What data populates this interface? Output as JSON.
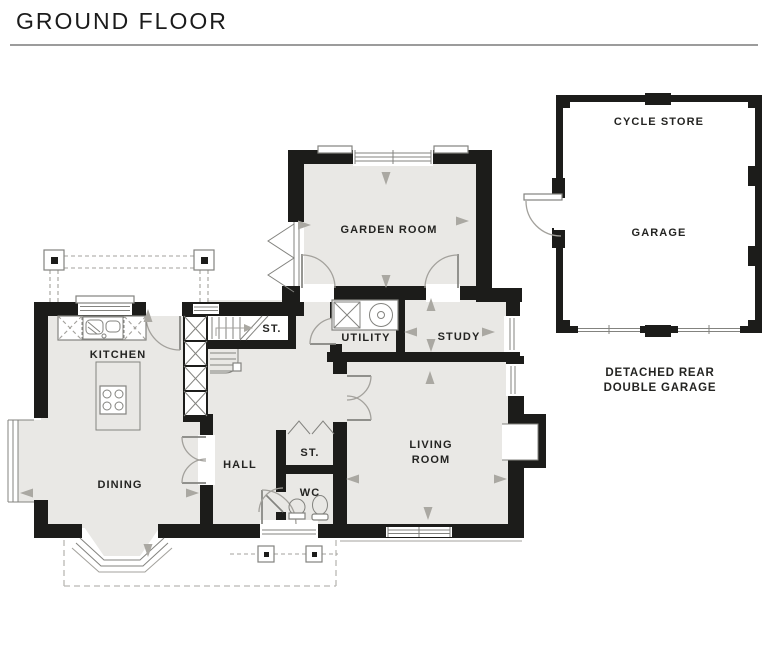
{
  "title": "GROUND FLOOR",
  "labels": {
    "garden_room": "GARDEN ROOM",
    "kitchen": "KITCHEN",
    "dining": "DINING",
    "hall": "HALL",
    "stair_store": "ST.",
    "utility": "UTILITY",
    "study": "STUDY",
    "hall_store": "ST.",
    "wc": "WC",
    "living_line1": "LIVING",
    "living_line2": "ROOM",
    "cycle_store": "CYCLE STORE",
    "garage": "GARAGE",
    "caption_line1": "DETACHED REAR",
    "caption_line2": "DOUBLE GARAGE"
  },
  "colors": {
    "wall": "#1c1c1a",
    "floor": "#e9e8e5",
    "paper": "#ffffff",
    "line": "#83837f",
    "lightline": "#a3a19c",
    "arrow": "#aaa8a2",
    "dash": "#b9b8b4",
    "text": "#242422",
    "title": "#1b1b1b",
    "divider": "#9c9c9c"
  }
}
